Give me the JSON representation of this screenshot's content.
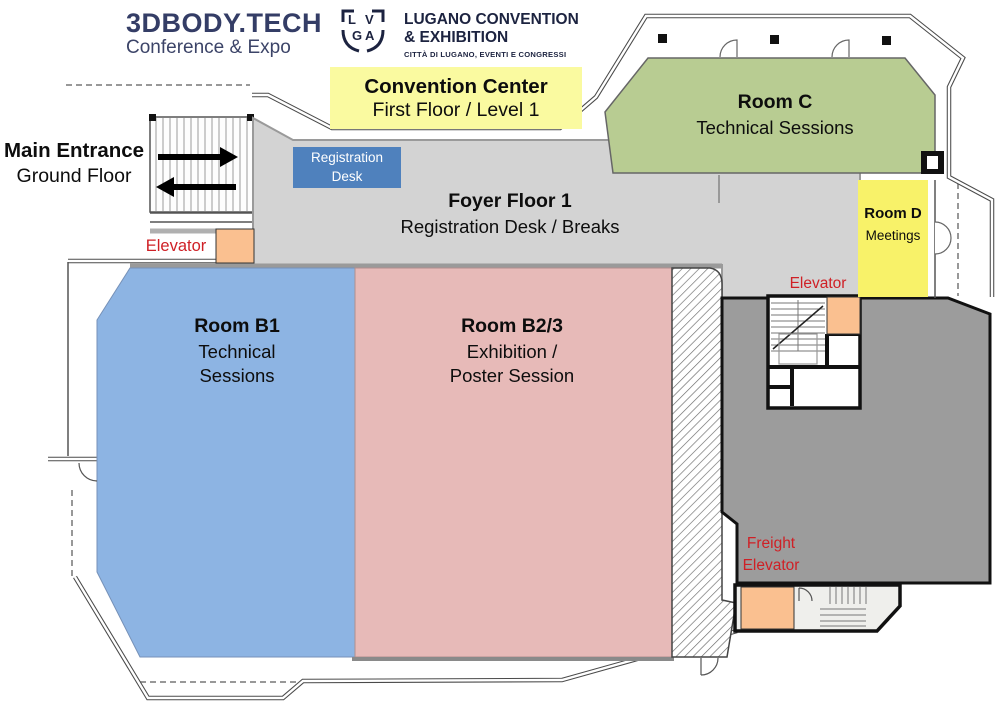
{
  "colors": {
    "room_c": "#b8cc92",
    "room_d": "#f8f269",
    "room_b1": "#8db4e3",
    "room_b23": "#e7bab8",
    "foyer": "#d3d3d3",
    "service_area": "#9c9c9c",
    "elevator_box": "#fac090",
    "registration_desk": "#4f81bd",
    "banner_yellow": "#fafaa0",
    "label_red": "#cf2026",
    "brand_navy": "#343d66"
  },
  "brand": {
    "name": "3DBODY.TECH",
    "tagline": "Conference & Expo"
  },
  "venue": {
    "mark_letters": [
      "L",
      "V",
      "G",
      "A"
    ],
    "name_line1": "LUGANO CONVENTION",
    "name_line2": "& EXHIBITION",
    "tagline": "CITTÀ DI LUGANO, EVENTI E CONGRESSI"
  },
  "banner": {
    "title": "Convention Center",
    "subtitle": "First Floor / Level 1"
  },
  "entrance": {
    "title": "Main Entrance",
    "subtitle": "Ground Floor"
  },
  "rooms": {
    "foyer": {
      "name": "Foyer Floor 1",
      "description": "Registration Desk / Breaks"
    },
    "registration": {
      "line1": "Registration",
      "line2": "Desk"
    },
    "room_c": {
      "name": "Room C",
      "description": "Technical Sessions"
    },
    "room_d": {
      "name": "Room D",
      "description": "Meetings"
    },
    "room_b1": {
      "name": "Room B1",
      "description_line1": "Technical",
      "description_line2": "Sessions"
    },
    "room_b23": {
      "name": "Room B2/3",
      "description_line1": "Exhibition /",
      "description_line2": "Poster Session"
    }
  },
  "labels": {
    "elevator_left": "Elevator",
    "elevator_right": "Elevator",
    "freight_elevator_line1": "Freight",
    "freight_elevator_line2": "Elevator"
  }
}
